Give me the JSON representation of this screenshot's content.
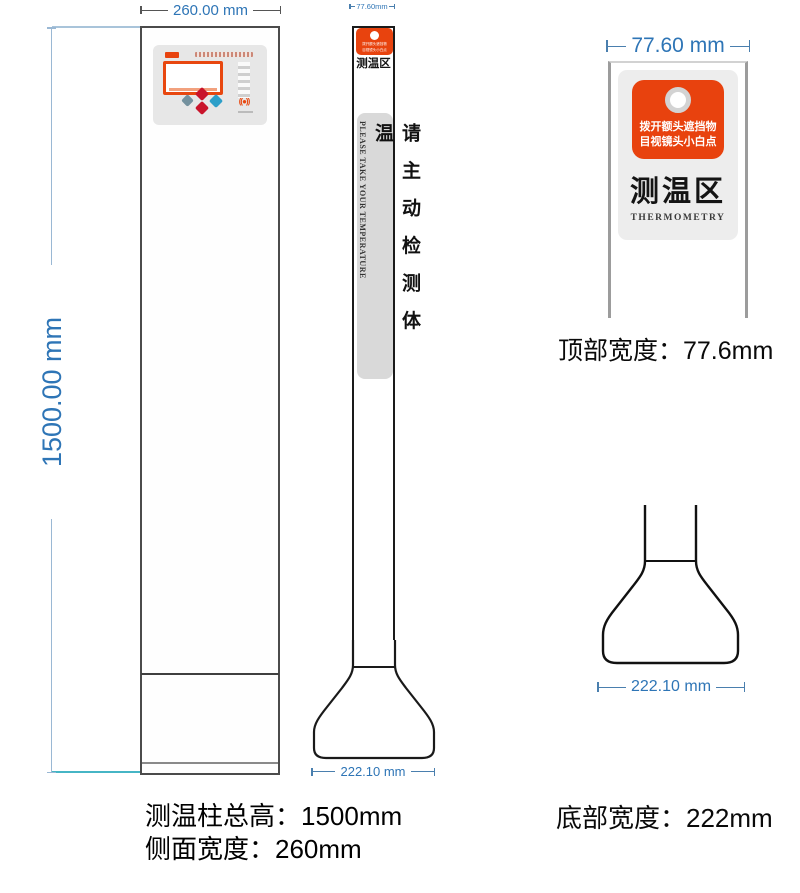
{
  "front_view": {
    "width_dim_label": "260.00 mm",
    "height_dim_label": "1500.00 mm",
    "panel": {
      "nfc_glyph": "((●))"
    }
  },
  "side_view": {
    "top_dim_label": "77.60mm",
    "zone_label": "测温区",
    "notice_cn": "请主动检测体温",
    "notice_en": "PLEASE TAKE YOUR TEMPERATURE",
    "bottom_dim_label": "222.10 mm"
  },
  "top_detail": {
    "width_dim_label": "77.60 mm",
    "sticker_line1": "拨开额头遮挡物",
    "sticker_line2": "目视镜头小白点",
    "zone_label": "测温区",
    "zone_label_en": "THERMOMETRY",
    "caption": "顶部宽度：77.6mm"
  },
  "base_detail": {
    "width_dim_label": "222.10 mm",
    "caption": "底部宽度：222mm"
  },
  "footer": {
    "total_height_label": "测温柱总高：1500mm",
    "side_width_label": "侧面宽度：260mm"
  },
  "colors": {
    "accent_orange": "#e8430e",
    "dimension_blue": "#2e75b6",
    "strip_gray": "#d9d9d9"
  }
}
